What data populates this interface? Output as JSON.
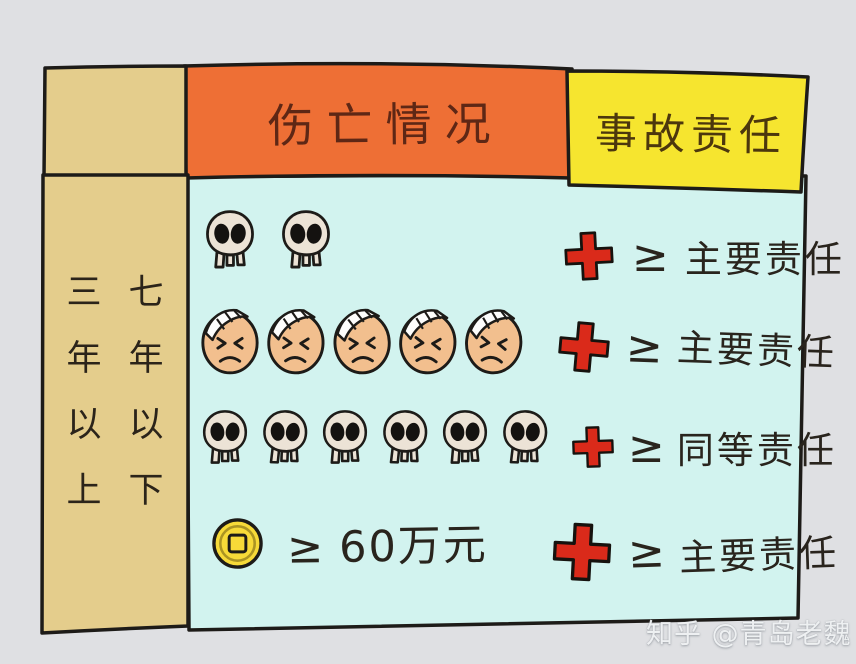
{
  "table": {
    "headers": {
      "casualty": {
        "label": "伤亡情况",
        "bg": "#ee6f35"
      },
      "responsibility": {
        "label": "事故责任",
        "bg": "#f6e52f"
      }
    },
    "duration_column": {
      "left_text": "三年以上",
      "right_text": "七年以下",
      "bg": "#e4cd8c"
    },
    "rows": [
      {
        "casualty_icon": "skull",
        "casualty_count": 2,
        "operator": "≥",
        "responsibility": "主要责任"
      },
      {
        "casualty_icon": "injured-face",
        "casualty_count": 5,
        "operator": "≥",
        "responsibility": "主要责任"
      },
      {
        "casualty_icon": "skull",
        "casualty_count": 6,
        "operator": "≥",
        "responsibility": "同等责任"
      },
      {
        "casualty_icon": "coin",
        "casualty_count": 1,
        "amount_operator": "≥",
        "amount": "60万元",
        "operator": "≥",
        "responsibility": "主要责任"
      }
    ]
  },
  "watermark": "知乎 @青岛老魏",
  "colors": {
    "canvas_bg": "#dfe0e3",
    "body_bg": "#d2f3ef",
    "header_casualty_bg": "#ee6f35",
    "header_responsibility_bg": "#f6e52f",
    "duration_bg": "#e4cd8c",
    "ink": "#1d1b18",
    "cross_red": "#da2a1a",
    "skull_fill": "#ece3d6",
    "face_fill": "#f2bf8e",
    "bandage_fill": "#fdfdfc",
    "coin_fill": "#f7da38",
    "header_text": "#5e2715",
    "body_text": "#29241d",
    "watermark_text": "#f5f7f9"
  }
}
